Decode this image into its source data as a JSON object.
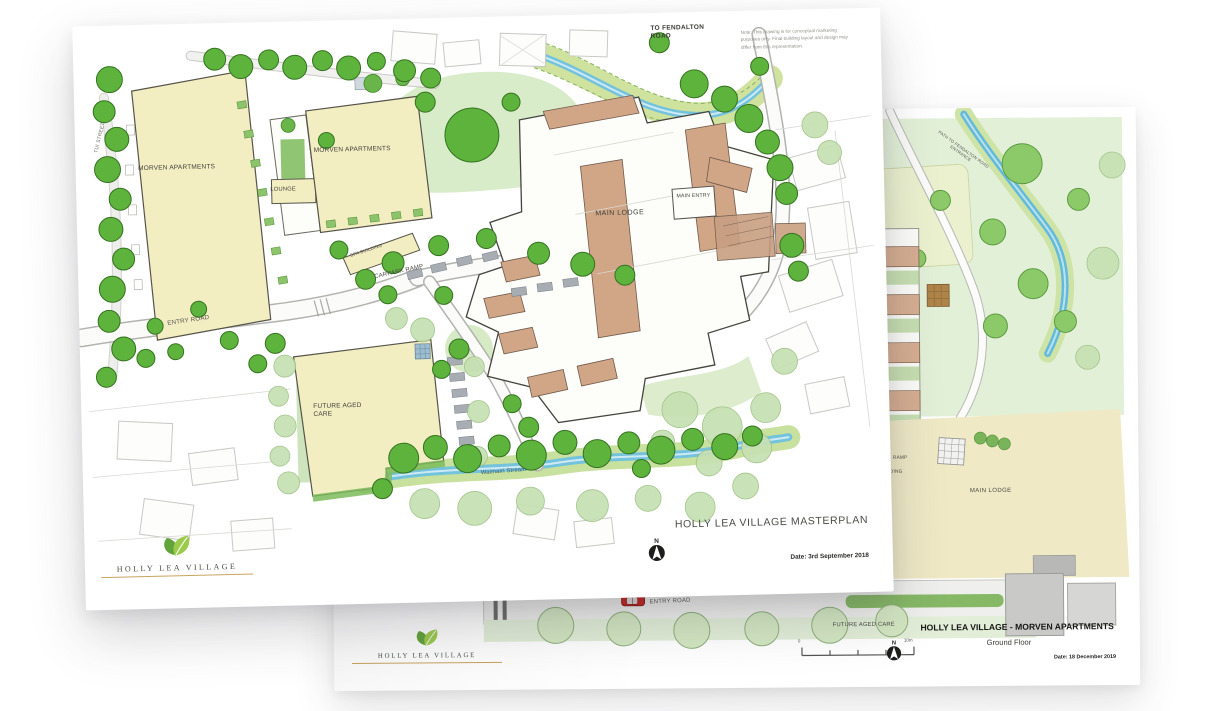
{
  "brand": {
    "name": "HOLLY LEA VILLAGE",
    "leaf_green_light": "#9ccb4c",
    "leaf_green_dark": "#62a33a",
    "rule_gold": "#c9a45f"
  },
  "front_sheet": {
    "title": "HOLLY LEA VILLAGE MASTERPLAN",
    "date": "Date: 3rd September 2018",
    "note": "Note: This drawing is for conceptual marketing purposes only. Final building layout and design may differ from this representation.",
    "north_label": "N",
    "labels": {
      "to_fendalton_road": "TO FENDALTON ROAD",
      "tui_street": "TUI STREET",
      "morven_apartments_west": "MORVEN APARTMENTS",
      "morven_apartments_east": "MORVEN APARTMENTS",
      "lounge": "LOUNGE",
      "main_lodge": "MAIN LODGE",
      "main_entry": "MAIN ENTRY",
      "spa_building": "SPA BUILDING",
      "carpark_ramp": "CARPARK RAMP",
      "entry_road": "ENTRY ROAD",
      "future_aged_care": "FUTURE AGED CARE",
      "stream": "Waimairi Stream"
    }
  },
  "back_sheet": {
    "title": "HOLLY LEA VILLAGE - MORVEN APARTMENTS",
    "subtitle": "Ground Floor",
    "date": "Date: 18 December 2019",
    "north_label": "N",
    "scale": {
      "start": "0",
      "end": "10m"
    },
    "labels": {
      "path_to_fendalton_road_entrance": "PATH TO FENDALTON ROAD ENTRANCE",
      "carpark_ramp": "CARPARK RAMP",
      "spa_building": "SPA BUILDING",
      "main_lodge": "MAIN LODGE",
      "entry_road": "ENTRY ROAD",
      "future_aged_care": "FUTURE AGED CARE"
    }
  },
  "colors": {
    "building_cream": "#f3edc2",
    "roof_tan": "#d0a687",
    "tree_green": "#5eb33d",
    "lawn_green": "#d9ecca",
    "stream_blue": "#74c3dc",
    "car_red": "#c5231f"
  }
}
